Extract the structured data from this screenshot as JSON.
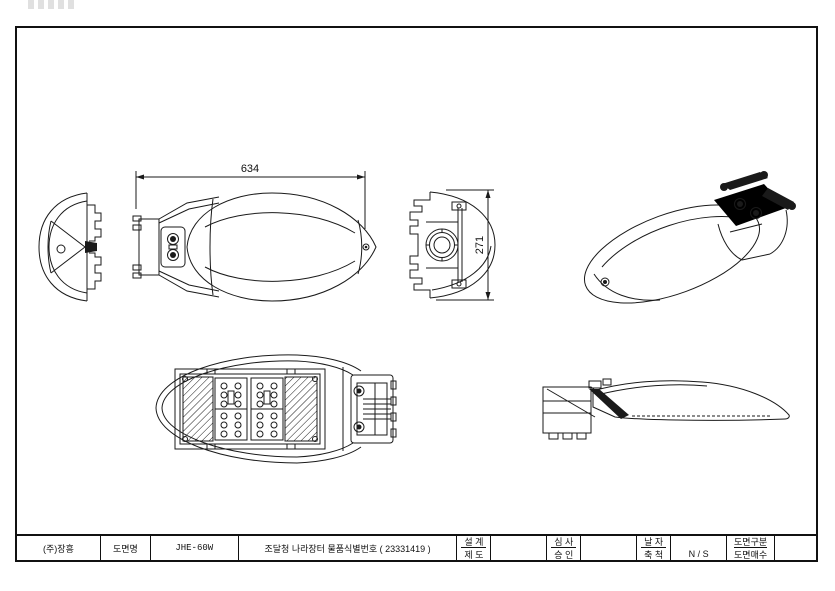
{
  "dimensions": {
    "length": "634",
    "height": "271"
  },
  "title_block": {
    "company": "(주)장흥",
    "drawing_name_label": "도면명",
    "drawing_name": "JHE-60W",
    "procurement_id_text": "조달청 나라장터 물품식별번호 ( 23331419 )",
    "design_label": "설 계",
    "design_value": "",
    "draft_label": "제 도",
    "draft_value": "",
    "review_label": "심 사",
    "review_value": "",
    "approval_label": "승 인",
    "approval_value": "",
    "date_label": "날 자",
    "date_value": "",
    "scale_label": "축 척",
    "scale_value": "N / S",
    "category_label": "도면구분",
    "category_value": "",
    "sheets_label": "도면매수",
    "sheets_value": ""
  },
  "colors": {
    "line": "#1a1a1a",
    "paper": "#ffffff"
  }
}
